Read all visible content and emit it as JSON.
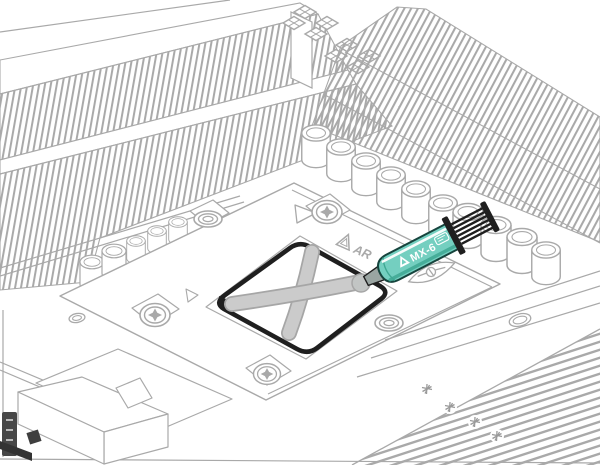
{
  "illustration": {
    "description": "Isometric line-art manual illustration: applying MX-6 thermal paste in an X pattern onto a CPU installed on a motherboard"
  },
  "colors": {
    "line": "#a9a9a9",
    "dark": "#1f1f1f",
    "paste_fill": "#cbcbcb",
    "paste_edge": "#a6a6a6",
    "paste_blob": "#c2c5c4",
    "teal": "#74cfc0",
    "teal_dark": "#3fa893",
    "teal_deep": "#16443d",
    "nozzle_gray": "#9aa5a2",
    "connector_dark": "#474747"
  },
  "syringe": {
    "label": "MX-6"
  },
  "socket": {
    "print_text": "AR"
  }
}
